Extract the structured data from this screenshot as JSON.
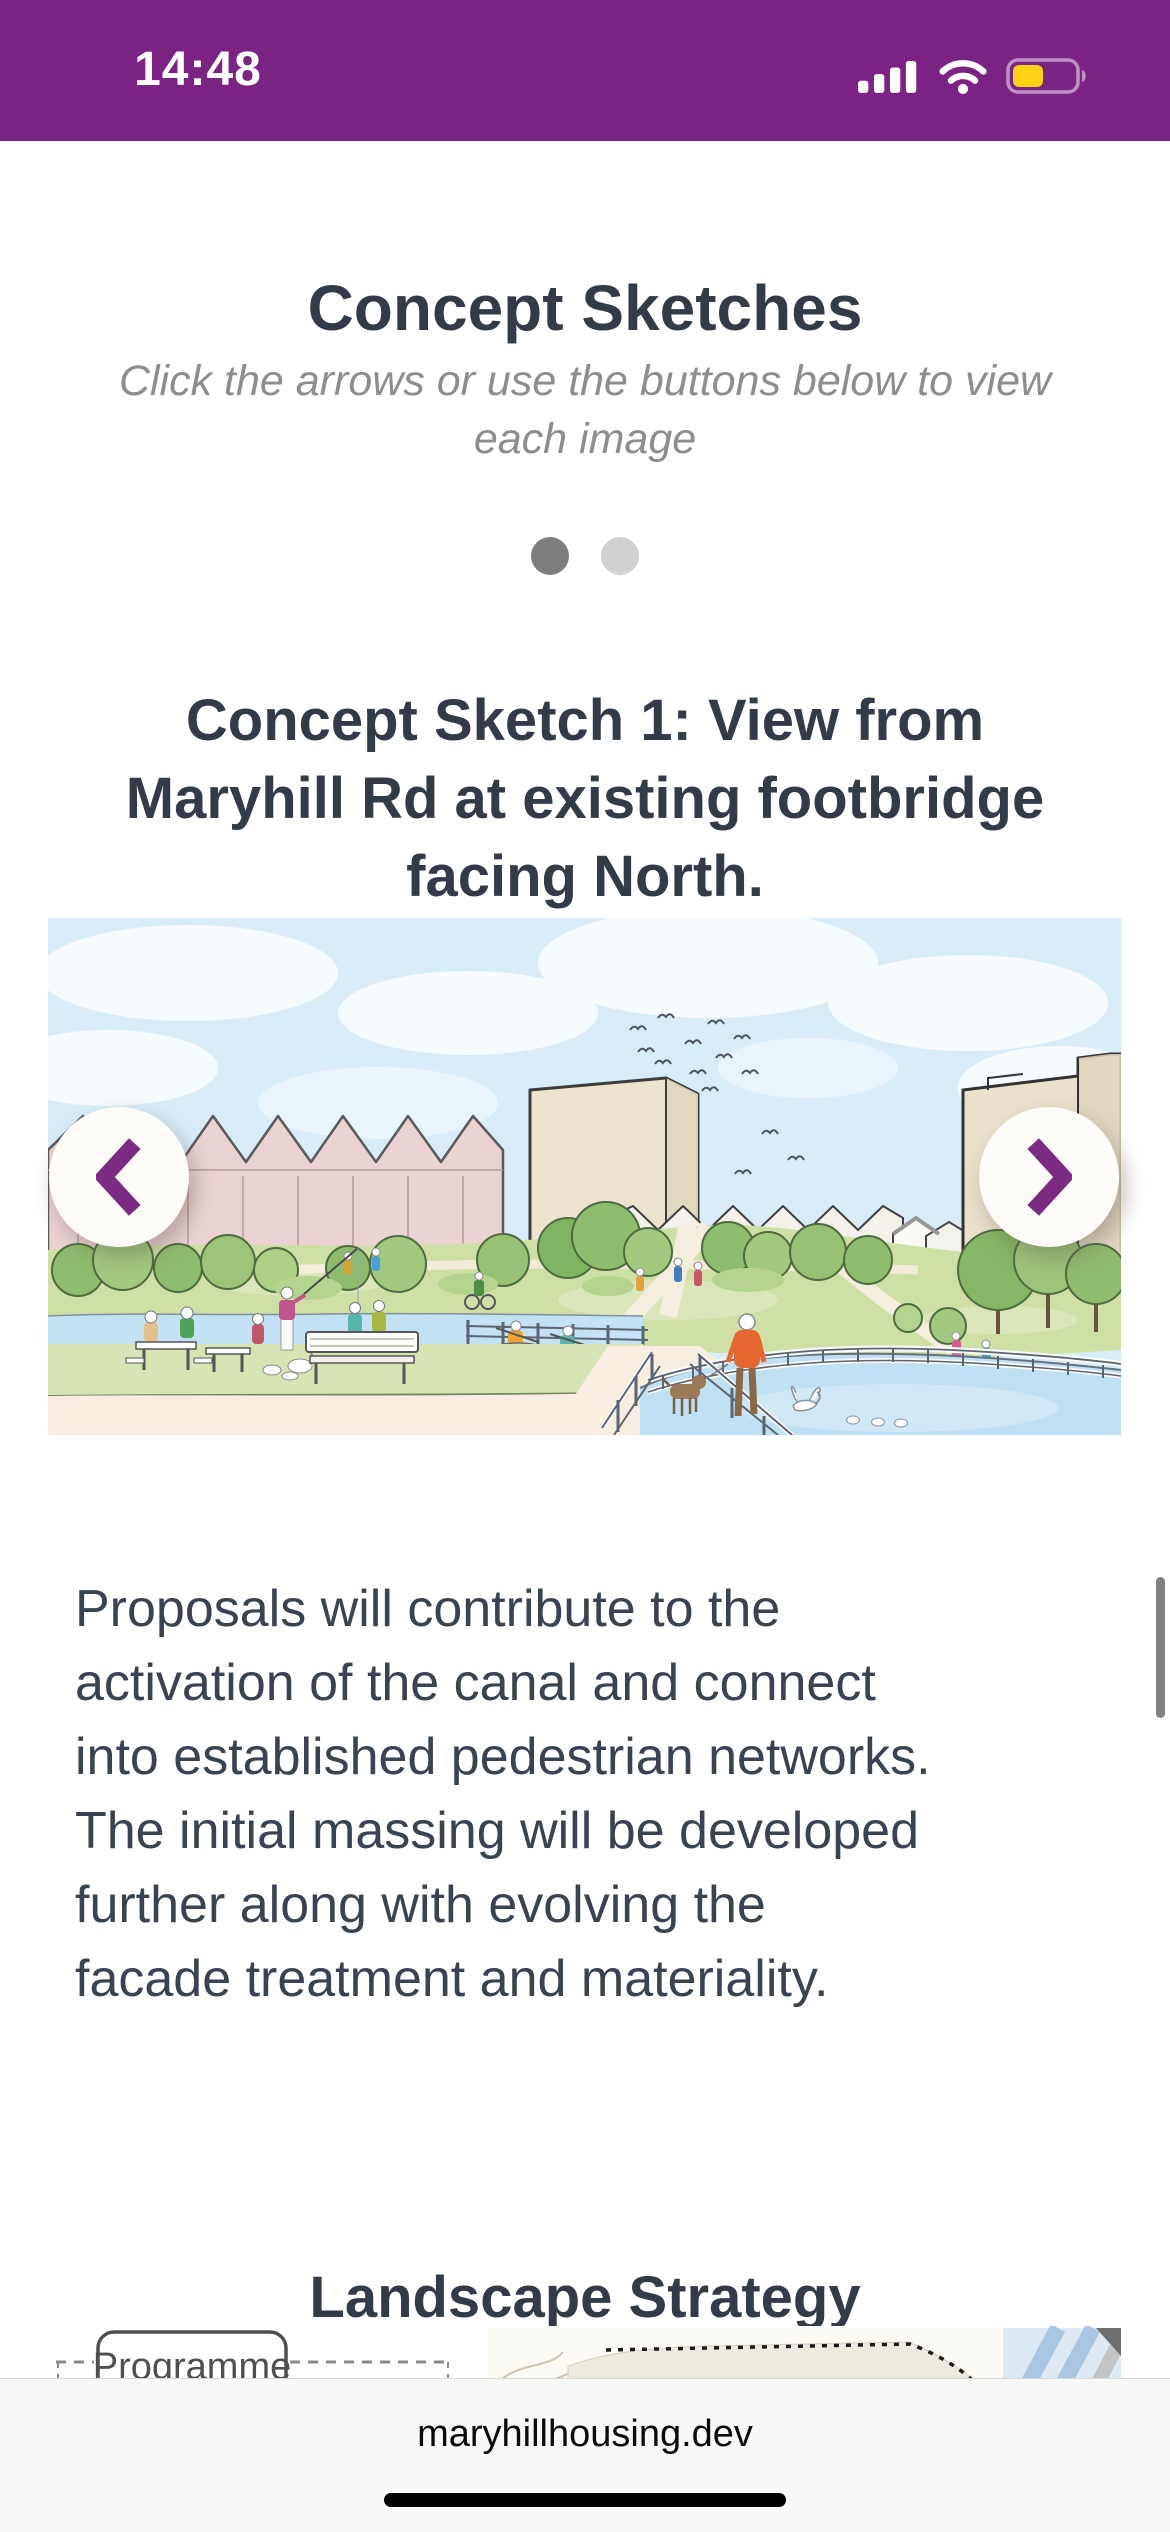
{
  "status_bar": {
    "time": "14:48",
    "battery_fill_percent": 45
  },
  "content": {
    "title": "Concept Sketches",
    "subtitle_lines": [
      "Click the arrows or use the buttons below to view",
      "each image"
    ],
    "carousel": {
      "active_slide": 1,
      "slide_count": 2,
      "slide_title_lines": [
        "Concept Sketch 1: View from",
        "Maryhill Rd at existing footbridge",
        "facing North."
      ]
    },
    "body_lines": [
      "Proposals will contribute to the",
      "activation of the canal and connect",
      "into established pedestrian networks.",
      "The initial massing will be developed",
      "further along with evolving the",
      "facade treatment and materiality."
    ],
    "section_title": "Landscape Strategy",
    "diagram": {
      "label": "Programme"
    }
  },
  "browser": {
    "url": "maryhillhousing.dev"
  },
  "colors": {
    "brand_purple": "#7b2383",
    "chevron_purple": "#7b2b82",
    "heading": "#333b48",
    "body_text": "#3a4351",
    "subtitle_gray": "#8d8d8d",
    "dot_active": "#7d7d7d",
    "dot_inactive": "#d1d1d1",
    "battery_yellow": "#ffd215"
  }
}
